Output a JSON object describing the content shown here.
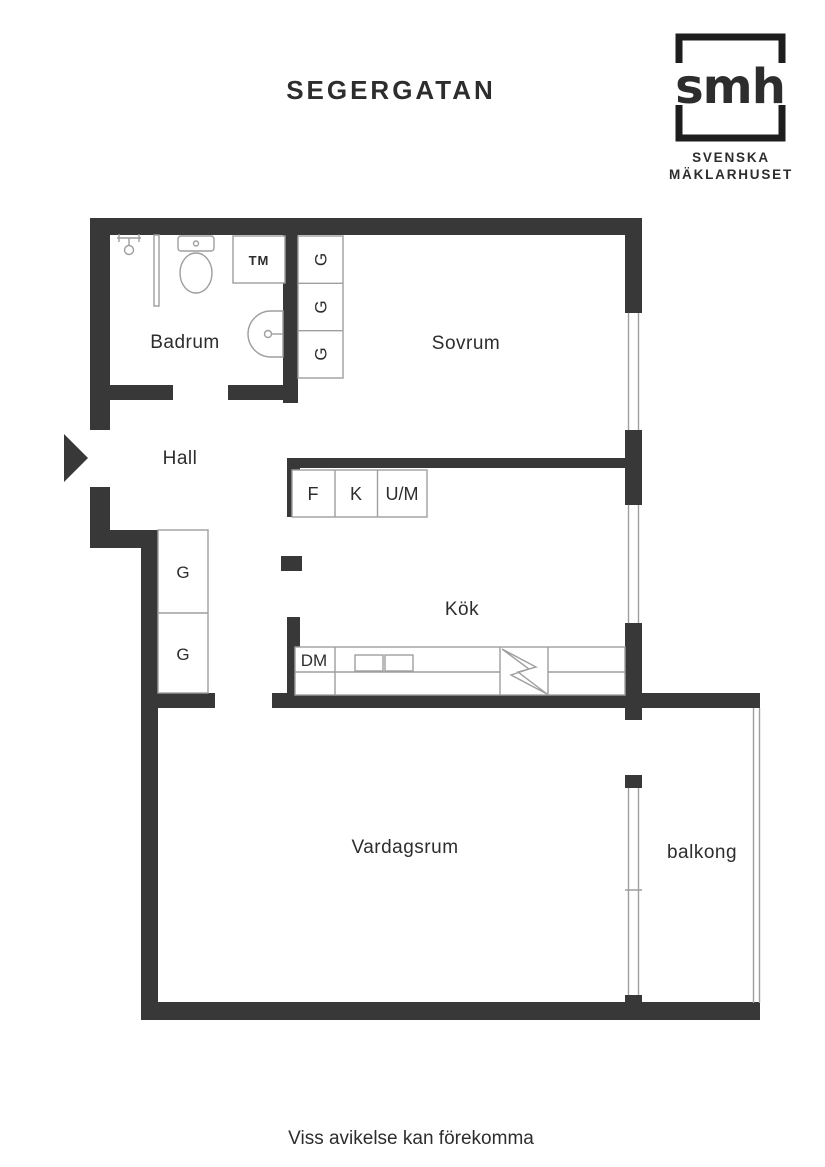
{
  "header": {
    "title": "SEGERGATAN"
  },
  "logo": {
    "monogram": "smh",
    "line1": "SVENSKA",
    "line2": "MÄKLARHUSET"
  },
  "rooms": {
    "badrum": "Badrum",
    "sovrum": "Sovrum",
    "hall": "Hall",
    "kok": "Kök",
    "vardagsrum": "Vardagsrum",
    "balkong": "balkong"
  },
  "fixtures": {
    "washing_machine": "TM",
    "dishwasher": "DM",
    "fridge": "F",
    "freezer": "K",
    "oven_micro": "U/M",
    "wardrobe": "G"
  },
  "footer": {
    "disclaimer": "Viss avikelse kan förekomma"
  },
  "colors": {
    "wall": "#383838",
    "thin_line": "#9e9e9e",
    "text": "#2d2d2d",
    "background": "#ffffff"
  }
}
